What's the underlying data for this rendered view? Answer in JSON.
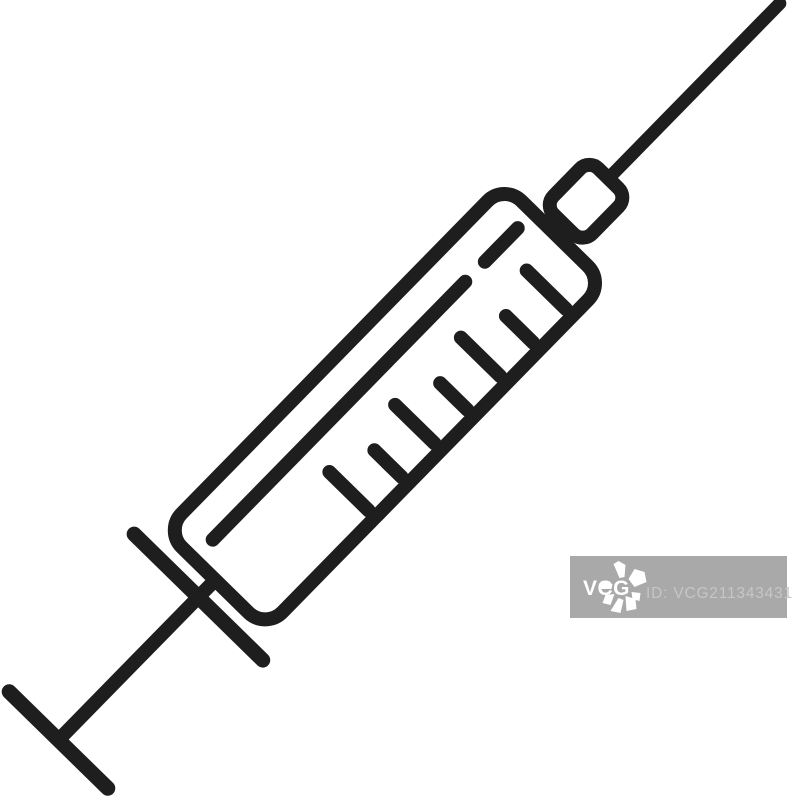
{
  "canvas": {
    "width": 793,
    "height": 800,
    "background_color": "#ffffff"
  },
  "icon": {
    "name": "syringe-outline-icon",
    "stroke_color": "#1e1e1e",
    "style": "black outline line-art, rotated diagonally, needle pointing to top-right corner",
    "tick_marks_count": 7
  },
  "watermark": {
    "box_color": "#a9a9a9",
    "logo_text": "VCG",
    "logo_text_color": "#ffffff",
    "flower_color": "#ffffff",
    "id_text": "ID: VCG211343431344",
    "id_text_color": "#c6c6c6"
  }
}
